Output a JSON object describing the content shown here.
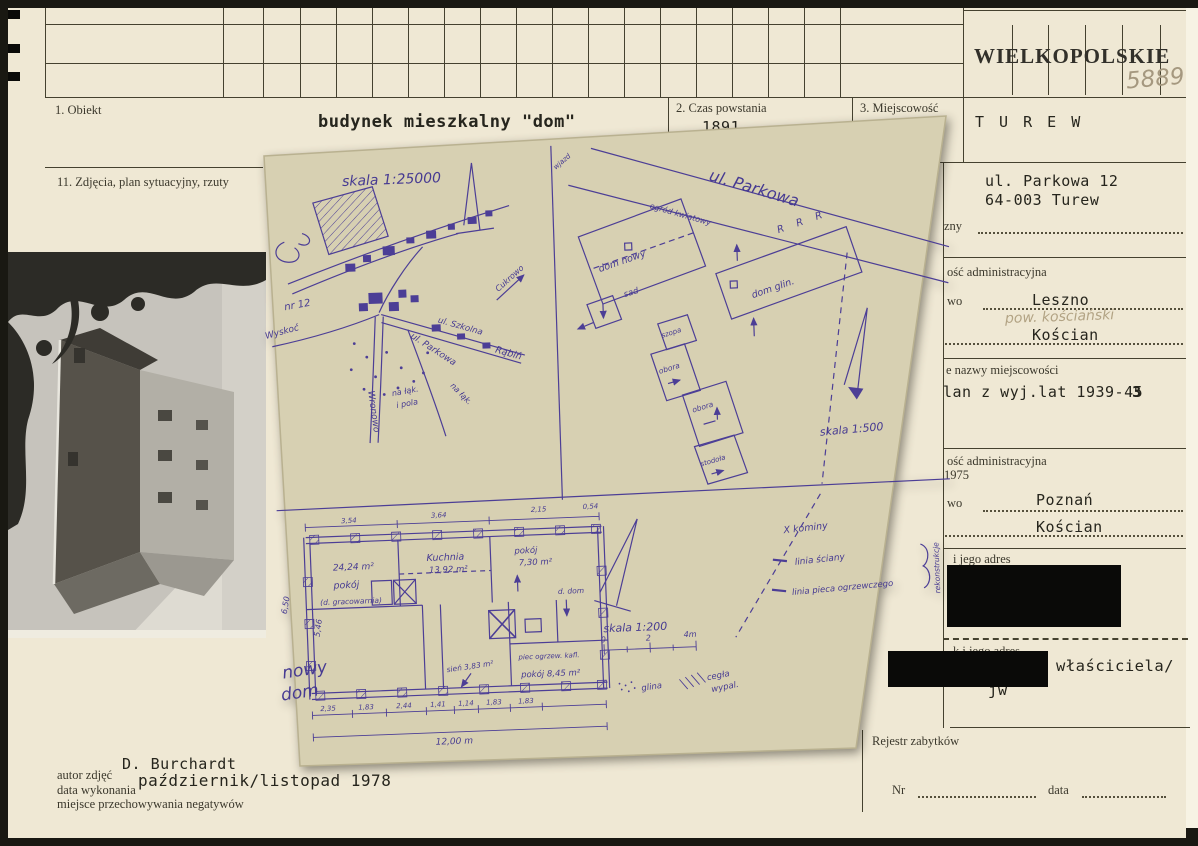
{
  "card": {
    "stamp": "WIELKOPOLSKIE",
    "pencil_number": "5889"
  },
  "fields": {
    "obiekt_label": "1. Obiekt",
    "obiekt_value": "budynek mieszkalny \"dom\"",
    "czas_label": "2. Czas powstania",
    "czas_value": "1891",
    "miejscowosc_label": "3. Miejscowość",
    "miejscowosc_value": "T U R E W",
    "zdjecia_label": "11. Zdjęcia, plan sytuacyjny, rzuty"
  },
  "right_column": {
    "address_line1": "ul. Parkowa 12",
    "address_line2": "64-003 Turew",
    "zny_label": "zny",
    "admin_old_label": "ość administracyjna",
    "wo_label": "wo",
    "admin_old_value1": "Leszno",
    "admin_old_pencil": "pow. kościański",
    "admin_old_value2": "Kościan",
    "names_label": "e nazwy miejscowości",
    "names_value": "lan z wyj.lat 1939-45",
    "names_overstrike": "3",
    "admin_new_label": "ość administracyjna",
    "admin_new_year": "1975",
    "admin_new_wo": "wo",
    "admin_new_value1": "Poznań",
    "admin_new_value2": "Kościan",
    "owner_addr_label": "i jego adres",
    "user_addr_label": "k i jego adres",
    "owner_value": "właściciela/",
    "owner_value2": "jw",
    "rejestr_label": "Rejestr zabytków",
    "nr_label": "Nr",
    "data_label": "data"
  },
  "footer": {
    "autor_label": "autor zdjęć",
    "autor_value": "D. Burchardt",
    "data_label": "data wykonania",
    "data_value": "październik/listopad 1978",
    "negatywy_label": "miejsce przechowywania negatywów"
  },
  "plan": {
    "map": {
      "scale": "skala 1:25000",
      "nr12": "nr 12",
      "wyskoc": "Wyskoć",
      "ul_szkolna": "ul. Szkolna",
      "rabin": "Rąbiń",
      "ul_parkowa": "ul. Parkowa",
      "na_laki": "na łąk.",
      "i_pola": "i pola",
      "na_laki2": "na łąk.",
      "wronowo": "Wronowo",
      "cukrowo": "Cukrowo"
    },
    "site": {
      "ul_parkowa": "ul. Parkowa",
      "wjazd": "wjazd",
      "ogrod": "ogród kwiatowy",
      "dom_nowy": "dom nowy",
      "dom_glin": "dom glin.",
      "rrr": "R R R",
      "sad": "sad",
      "szopa": "szopa",
      "obora1": "obora",
      "obora2": "obora",
      "stodola": "stodoła",
      "scale": "skala 1:500"
    },
    "floor": {
      "title_line1": "nowy",
      "title_line2": "dom",
      "room1_area": "24,24 m²",
      "room1_name": "pokój",
      "room1_note": "(d. gracowarnia)",
      "kitchen_name": "Kuchnia",
      "kitchen_area": "13,92 m²",
      "room2_name": "pokój",
      "room2_area": "7,30 m²",
      "sien": "sień 3,83 m²",
      "room3_note": "piec ogrzew. kafl.",
      "room3": "pokój 8,45 m²",
      "d_dom": "d. dom",
      "dims_top": [
        "3,54",
        "3,64",
        "2,15",
        "0,54"
      ],
      "dims_left": [
        "6,50",
        "5,46"
      ],
      "dims_bottom": [
        "2,35",
        "1,83",
        "2,44",
        "1,41",
        "1,14",
        "1,83",
        "1,83"
      ],
      "dim_total": "12,00 m"
    },
    "legend": {
      "kominy": "X kominy",
      "sciana": "linia ściany",
      "piec": "linia pieca ogrzewczego",
      "rekonstrukcja": "rekonstrukcje",
      "scale": "skala 1:200",
      "bar_0": "0",
      "bar_2": "2",
      "bar_4": "4m",
      "glina": "glina",
      "cegla_1": "cegła",
      "cegla_2": "wypal."
    }
  },
  "colors": {
    "ink": "#4c3e96",
    "paper": "#efe8d4",
    "plan_paper": "#d7d0b2"
  }
}
